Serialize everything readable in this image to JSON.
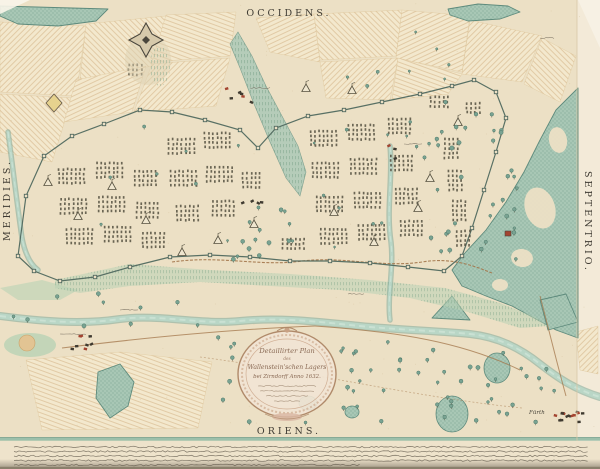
{
  "compass": {
    "top": "OCCIDENS.",
    "bottom": "ORIENS.",
    "left": "MERIDIES.",
    "right": "SEPTENTRIO."
  },
  "cartouche": {
    "lines": [
      "Detaillirter Plan",
      "des",
      "Wallenstein'schen Lagers",
      "bei Zirndorff Anno 1632."
    ],
    "dedication_squiggle_lines": 4
  },
  "place_labels": [
    {
      "text": "Fürth",
      "x": 529,
      "y": 414
    }
  ],
  "footnote": {
    "squiggle_lines": 5
  },
  "colors": {
    "paper": "#ece0c5",
    "paper_light": "#f3ead8",
    "patch": "#f3e8cd",
    "hatch": "#d2b082",
    "forest": "#a8c7b5",
    "forest_dark": "#5d8a7c",
    "water": "#b9d6c6",
    "water_dark": "#7ea899",
    "water_light": "#d2e5d8",
    "ink": "#4a463c",
    "tent_ink": "#55503f",
    "red": "#a34430",
    "brown": "#a3764a",
    "boundary": "#50695f",
    "green_wash": "#b9d2b4",
    "cart_frame": "#b08a6a",
    "cart_fill": "#f2e4d4"
  },
  "features": {
    "hatch_patches": [
      {
        "pts": [
          [
            0,
            22
          ],
          [
            86,
            26
          ],
          [
            76,
            96
          ],
          [
            0,
            92
          ]
        ],
        "p": "h2"
      },
      {
        "pts": [
          [
            86,
            24
          ],
          [
            166,
            16
          ],
          [
            152,
            66
          ],
          [
            80,
            80
          ]
        ],
        "p": "h1"
      },
      {
        "pts": [
          [
            166,
            15
          ],
          [
            236,
            12
          ],
          [
            230,
            56
          ],
          [
            152,
            62
          ]
        ],
        "p": "h3"
      },
      {
        "pts": [
          [
            0,
            94
          ],
          [
            72,
            98
          ],
          [
            52,
            162
          ],
          [
            0,
            152
          ]
        ],
        "p": "h1"
      },
      {
        "pts": [
          [
            76,
            80
          ],
          [
            146,
            66
          ],
          [
            132,
            112
          ],
          [
            64,
            122
          ]
        ],
        "p": "h4"
      },
      {
        "pts": [
          [
            152,
            64
          ],
          [
            230,
            58
          ],
          [
            216,
            106
          ],
          [
            134,
            112
          ]
        ],
        "p": "h2"
      },
      {
        "pts": [
          [
            256,
            18
          ],
          [
            314,
            14
          ],
          [
            320,
            62
          ],
          [
            270,
            52
          ]
        ],
        "p": "h4"
      },
      {
        "pts": [
          [
            314,
            14
          ],
          [
            402,
            10
          ],
          [
            396,
            56
          ],
          [
            320,
            60
          ]
        ],
        "p": "h1"
      },
      {
        "pts": [
          [
            402,
            10
          ],
          [
            470,
            16
          ],
          [
            462,
            72
          ],
          [
            396,
            58
          ]
        ],
        "p": "h4"
      },
      {
        "pts": [
          [
            320,
            62
          ],
          [
            398,
            58
          ],
          [
            390,
            100
          ],
          [
            326,
            98
          ]
        ],
        "p": "h2"
      },
      {
        "pts": [
          [
            398,
            58
          ],
          [
            462,
            74
          ],
          [
            448,
            94
          ],
          [
            392,
            100
          ]
        ],
        "p": "h3"
      },
      {
        "pts": [
          [
            470,
            20
          ],
          [
            542,
            36
          ],
          [
            522,
            82
          ],
          [
            462,
            74
          ]
        ],
        "p": "h2"
      },
      {
        "pts": [
          [
            542,
            38
          ],
          [
            576,
            56
          ],
          [
            560,
            102
          ],
          [
            524,
            84
          ]
        ],
        "p": "h1"
      },
      {
        "pts": [
          [
            26,
            360
          ],
          [
            120,
            352
          ],
          [
            212,
            362
          ],
          [
            198,
            428
          ],
          [
            42,
            430
          ]
        ],
        "p": "h3"
      },
      {
        "pts": [
          [
            560,
            122
          ],
          [
            578,
            110
          ],
          [
            578,
            162
          ],
          [
            562,
            152
          ]
        ],
        "p": "h1"
      },
      {
        "pts": [
          [
            530,
            256
          ],
          [
            570,
            242
          ],
          [
            576,
            278
          ],
          [
            542,
            288
          ]
        ],
        "p": "h4"
      },
      {
        "pts": [
          [
            576,
            332
          ],
          [
            598,
            326
          ],
          [
            598,
            374
          ],
          [
            580,
            370
          ]
        ],
        "p": "h2"
      }
    ],
    "forest_polys": [
      [
        [
          0,
          6
        ],
        [
          108,
          9
        ],
        [
          96,
          21
        ],
        [
          58,
          26
        ],
        [
          18,
          24
        ],
        [
          0,
          16
        ]
      ],
      [
        [
          448,
          9
        ],
        [
          478,
          4
        ],
        [
          508,
          6
        ],
        [
          520,
          12
        ],
        [
          500,
          19
        ],
        [
          468,
          21
        ],
        [
          450,
          15
        ]
      ],
      [
        [
          578,
          88
        ],
        [
          556,
          110
        ],
        [
          540,
          140
        ],
        [
          524,
          172
        ],
        [
          506,
          202
        ],
        [
          486,
          230
        ],
        [
          464,
          254
        ],
        [
          452,
          270
        ],
        [
          462,
          286
        ],
        [
          486,
          296
        ],
        [
          512,
          306
        ],
        [
          534,
          318
        ],
        [
          556,
          330
        ],
        [
          578,
          338
        ]
      ],
      [
        [
          432,
          318
        ],
        [
          452,
          296
        ],
        [
          470,
          320
        ]
      ],
      [
        [
          540,
          300
        ],
        [
          566,
          294
        ],
        [
          578,
          322
        ],
        [
          548,
          330
        ]
      ],
      [
        [
          98,
          372
        ],
        [
          120,
          364
        ],
        [
          134,
          382
        ],
        [
          128,
          406
        ],
        [
          110,
          418
        ],
        [
          96,
          398
        ]
      ]
    ],
    "forest_inlets": [
      {
        "cx": 540,
        "cy": 208,
        "rx": 15,
        "ry": 21,
        "rot": -18
      },
      {
        "cx": 522,
        "cy": 258,
        "rx": 11,
        "ry": 9,
        "rot": 10
      },
      {
        "cx": 558,
        "cy": 140,
        "rx": 9,
        "ry": 13,
        "rot": -10
      },
      {
        "cx": 500,
        "cy": 285,
        "rx": 8,
        "ry": 6,
        "rot": 0
      }
    ],
    "groves": [
      {
        "cx": 452,
        "cy": 414,
        "rx": 16,
        "ry": 18
      },
      {
        "cx": 497,
        "cy": 368,
        "rx": 13,
        "ry": 15
      },
      {
        "cx": 308,
        "cy": 403,
        "rx": 9,
        "ry": 7
      },
      {
        "cx": 352,
        "cy": 412,
        "rx": 7,
        "ry": 6
      }
    ],
    "ravine": [
      [
        238,
        32
      ],
      [
        252,
        56
      ],
      [
        266,
        86
      ],
      [
        282,
        116
      ],
      [
        298,
        146
      ],
      [
        306,
        172
      ],
      [
        300,
        196
      ],
      [
        286,
        178
      ],
      [
        270,
        142
      ],
      [
        254,
        104
      ],
      [
        240,
        68
      ],
      [
        230,
        44
      ]
    ],
    "ridge_wash": [
      [
        55,
        280
      ],
      [
        130,
        264
      ],
      [
        210,
        270
      ],
      [
        290,
        274
      ],
      [
        370,
        280
      ],
      [
        445,
        288
      ],
      [
        500,
        303
      ],
      [
        535,
        317
      ],
      [
        548,
        326
      ],
      [
        520,
        328
      ],
      [
        468,
        312
      ],
      [
        410,
        298
      ],
      [
        340,
        290
      ],
      [
        270,
        286
      ],
      [
        200,
        282
      ],
      [
        130,
        286
      ],
      [
        80,
        293
      ],
      [
        55,
        288
      ]
    ],
    "west_ridge": [
      [
        0,
        288
      ],
      [
        42,
        280
      ],
      [
        78,
        290
      ],
      [
        60,
        300
      ],
      [
        18,
        300
      ]
    ],
    "hill_left": {
      "cx": 30,
      "cy": 345,
      "rx": 26,
      "ry": 12,
      "top_cx": 27,
      "top_cy": 343,
      "top_r": 8
    },
    "river_main": "M0,316 C40,321 80,325 120,319 C160,314 200,325 240,321 C280,317 320,322 360,326 C400,330 440,331 470,334 C498,337 520,348 540,364 C558,378 574,389 600,397",
    "stream": "M390,146 C393,178 386,210 391,242 C394,268 387,296 390,320",
    "left_stream": "M8,132 C13,168 17,204 22,238 C25,254 30,264 38,270",
    "roads": [
      "M62,348 C150,337 240,329 315,326",
      "M315,326 C400,332 462,342 520,370",
      "M540,296 C548,326 556,360 566,396",
      "M200,357 C300,370 420,398 522,408"
    ],
    "ridge_line": "M172,262 C220,255 262,267 302,261 C342,256 382,268 422,262 C452,257 474,266 492,273",
    "camp_outline": [
      [
        18,
        256
      ],
      [
        26,
        196
      ],
      [
        44,
        156
      ],
      [
        72,
        136
      ],
      [
        104,
        124
      ],
      [
        140,
        110
      ],
      [
        172,
        112
      ],
      [
        205,
        120
      ],
      [
        240,
        130
      ],
      [
        258,
        148
      ],
      [
        276,
        128
      ],
      [
        308,
        116
      ],
      [
        344,
        110
      ],
      [
        382,
        102
      ],
      [
        420,
        94
      ],
      [
        452,
        86
      ],
      [
        474,
        80
      ],
      [
        496,
        92
      ],
      [
        506,
        118
      ],
      [
        496,
        152
      ],
      [
        484,
        190
      ],
      [
        472,
        228
      ],
      [
        462,
        256
      ],
      [
        444,
        271
      ],
      [
        408,
        267
      ],
      [
        370,
        263
      ],
      [
        330,
        261
      ],
      [
        290,
        261
      ],
      [
        250,
        257
      ],
      [
        210,
        255
      ],
      [
        170,
        257
      ],
      [
        130,
        267
      ],
      [
        95,
        277
      ],
      [
        60,
        281
      ],
      [
        34,
        271
      ]
    ],
    "star_fort": {
      "cx": 146,
      "cy": 40
    },
    "small_fort": [
      [
        54,
        94
      ],
      [
        62,
        103
      ],
      [
        54,
        112
      ],
      [
        46,
        103
      ]
    ],
    "red_fort": {
      "x": 505,
      "y": 231
    },
    "tent_blocks": [
      [
        58,
        168,
        7,
        4
      ],
      [
        96,
        162,
        7,
        4
      ],
      [
        134,
        170,
        6,
        4
      ],
      [
        60,
        198,
        7,
        4
      ],
      [
        98,
        196,
        7,
        4
      ],
      [
        136,
        202,
        6,
        4
      ],
      [
        66,
        228,
        7,
        4
      ],
      [
        104,
        226,
        7,
        4
      ],
      [
        142,
        232,
        6,
        4
      ],
      [
        168,
        138,
        7,
        4
      ],
      [
        204,
        132,
        7,
        4
      ],
      [
        170,
        170,
        7,
        4
      ],
      [
        206,
        166,
        7,
        4
      ],
      [
        242,
        172,
        5,
        4
      ],
      [
        176,
        205,
        6,
        4
      ],
      [
        212,
        200,
        6,
        4
      ],
      [
        310,
        130,
        7,
        4
      ],
      [
        348,
        124,
        7,
        4
      ],
      [
        388,
        118,
        6,
        4
      ],
      [
        312,
        162,
        7,
        4
      ],
      [
        350,
        158,
        7,
        4
      ],
      [
        390,
        155,
        6,
        4
      ],
      [
        316,
        196,
        7,
        4
      ],
      [
        354,
        192,
        7,
        4
      ],
      [
        395,
        188,
        6,
        4
      ],
      [
        320,
        228,
        7,
        4
      ],
      [
        358,
        224,
        7,
        4
      ],
      [
        400,
        220,
        6,
        4
      ],
      [
        444,
        138,
        4,
        5
      ],
      [
        448,
        170,
        4,
        5
      ],
      [
        452,
        200,
        4,
        5
      ],
      [
        456,
        230,
        4,
        4
      ],
      [
        430,
        96,
        5,
        3
      ],
      [
        466,
        102,
        4,
        3
      ],
      [
        128,
        64,
        4,
        3
      ],
      [
        282,
        238,
        6,
        3
      ]
    ],
    "tri_tents": [
      [
        48,
        178
      ],
      [
        78,
        212
      ],
      [
        112,
        182
      ],
      [
        146,
        216
      ],
      [
        182,
        248
      ],
      [
        218,
        236
      ],
      [
        254,
        220
      ],
      [
        334,
        208
      ],
      [
        374,
        238
      ],
      [
        418,
        204
      ],
      [
        430,
        174
      ],
      [
        458,
        118
      ],
      [
        306,
        84
      ],
      [
        352,
        86
      ]
    ],
    "villages": [
      {
        "x": 80,
        "y": 340,
        "n": 8,
        "red": true
      },
      {
        "x": 238,
        "y": 94,
        "n": 6,
        "red": true
      },
      {
        "x": 396,
        "y": 150,
        "n": 3,
        "red": true
      },
      {
        "x": 568,
        "y": 416,
        "n": 14,
        "red": true
      },
      {
        "x": 250,
        "y": 196,
        "n": 4,
        "red": false
      }
    ],
    "tree_zones": [
      {
        "x0": 215,
        "y0": 336,
        "x1": 560,
        "y1": 424,
        "n": 60,
        "small": false
      },
      {
        "x0": 10,
        "y0": 292,
        "x1": 200,
        "y1": 326,
        "n": 10,
        "small": false
      },
      {
        "x0": 428,
        "y0": 96,
        "x1": 520,
        "y1": 262,
        "n": 36,
        "small": false
      },
      {
        "x0": 70,
        "y0": 120,
        "x1": 450,
        "y1": 258,
        "n": 22,
        "small": true
      },
      {
        "x0": 232,
        "y0": 198,
        "x1": 330,
        "y1": 260,
        "n": 14,
        "small": false
      },
      {
        "x0": 300,
        "y0": 30,
        "x1": 460,
        "y1": 90,
        "n": 8,
        "small": true
      }
    ],
    "micro_labels": [
      {
        "x": 60,
        "y": 334,
        "w": 26
      },
      {
        "x": 250,
        "y": 88,
        "w": 20
      },
      {
        "x": 404,
        "y": 144,
        "w": 18
      },
      {
        "x": 348,
        "y": 294,
        "w": 16
      },
      {
        "x": 540,
        "y": 38,
        "w": 14
      },
      {
        "x": 120,
        "y": 310,
        "w": 18
      }
    ],
    "caption_lines": [
      {
        "x0": 14,
        "x1": 588,
        "y": 447
      },
      {
        "x0": 14,
        "x1": 588,
        "y": 451.5
      },
      {
        "x0": 14,
        "x1": 588,
        "y": 456
      },
      {
        "x0": 14,
        "x1": 588,
        "y": 460.5
      },
      {
        "x0": 14,
        "x1": 360,
        "y": 465
      }
    ],
    "dedication_squiggles": [
      {
        "x0": 258,
        "x1": 316,
        "y": 386
      },
      {
        "x0": 260,
        "x1": 314,
        "y": 391
      },
      {
        "x0": 266,
        "x1": 308,
        "y": 396
      },
      {
        "x0": 274,
        "x1": 300,
        "y": 401
      }
    ]
  }
}
